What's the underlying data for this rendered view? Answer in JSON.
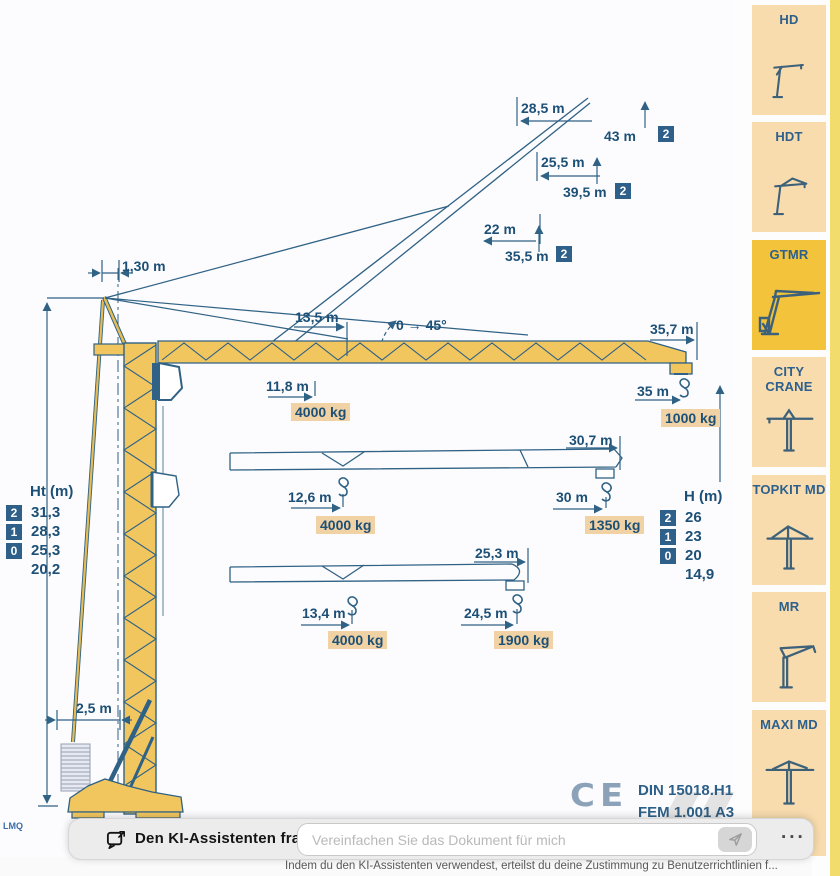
{
  "page": {
    "corner_label": "LMQ",
    "ce_mark": "CE",
    "standards": {
      "line1": "DIN 15018.H1 B3",
      "line2": "FEM 1.001 A3"
    }
  },
  "diagram": {
    "apex_offset": "1,30 m",
    "base_width": "2,5 m",
    "slew_dim": "13,5 m",
    "luffing_angle": "0 → 45°",
    "luffing_configs": [
      {
        "radius": "28,5 m",
        "height": "43 m",
        "badge": "2"
      },
      {
        "radius": "25,5 m",
        "height": "39,5 m",
        "badge": "2"
      },
      {
        "radius": "22 m",
        "height": "35,5 m",
        "badge": "2"
      }
    ],
    "jib_configs": [
      {
        "length": "35,7 m",
        "load_radius": "11,8 m",
        "load": "4000 kg",
        "tip_radius": "35 m",
        "tip_load": "1000 kg"
      },
      {
        "length": "30,7 m",
        "load_radius": "12,6 m",
        "load": "4000 kg",
        "tip_radius": "30 m",
        "tip_load": "1350 kg"
      },
      {
        "length": "25,3 m",
        "load_radius": "13,4 m",
        "load": "4000 kg",
        "tip_radius": "24,5 m",
        "tip_load": "1900 kg"
      }
    ],
    "ht_table": {
      "title": "Ht (m)",
      "rows": [
        {
          "badge": "2",
          "value": "31,3"
        },
        {
          "badge": "1",
          "value": "28,3"
        },
        {
          "badge": "0",
          "value": "25,3"
        },
        {
          "badge": "",
          "value": "20,2"
        }
      ]
    },
    "h_table": {
      "title": "H (m)",
      "rows": [
        {
          "badge": "2",
          "value": "26"
        },
        {
          "badge": "1",
          "value": "23"
        },
        {
          "badge": "0",
          "value": "20"
        },
        {
          "badge": "",
          "value": "14,9"
        }
      ]
    }
  },
  "sidebar": {
    "items": [
      {
        "label": "HD"
      },
      {
        "label": "HDT"
      },
      {
        "label": "GTMR"
      },
      {
        "label": "CITY CRANE"
      },
      {
        "label": "TOPKIT MD"
      },
      {
        "label": "MR"
      },
      {
        "label": "MAXI MD"
      }
    ]
  },
  "assistant_bar": {
    "title": "Den KI-Assistenten fragen",
    "input_placeholder": "Vereinfachen Sie das Dokument für mich",
    "more_label": "...",
    "disclaimer": "Indem du den KI-Assistenten verwendest, erteilst du deine Zustimmung zu Benutzerrichtlinien f..."
  }
}
